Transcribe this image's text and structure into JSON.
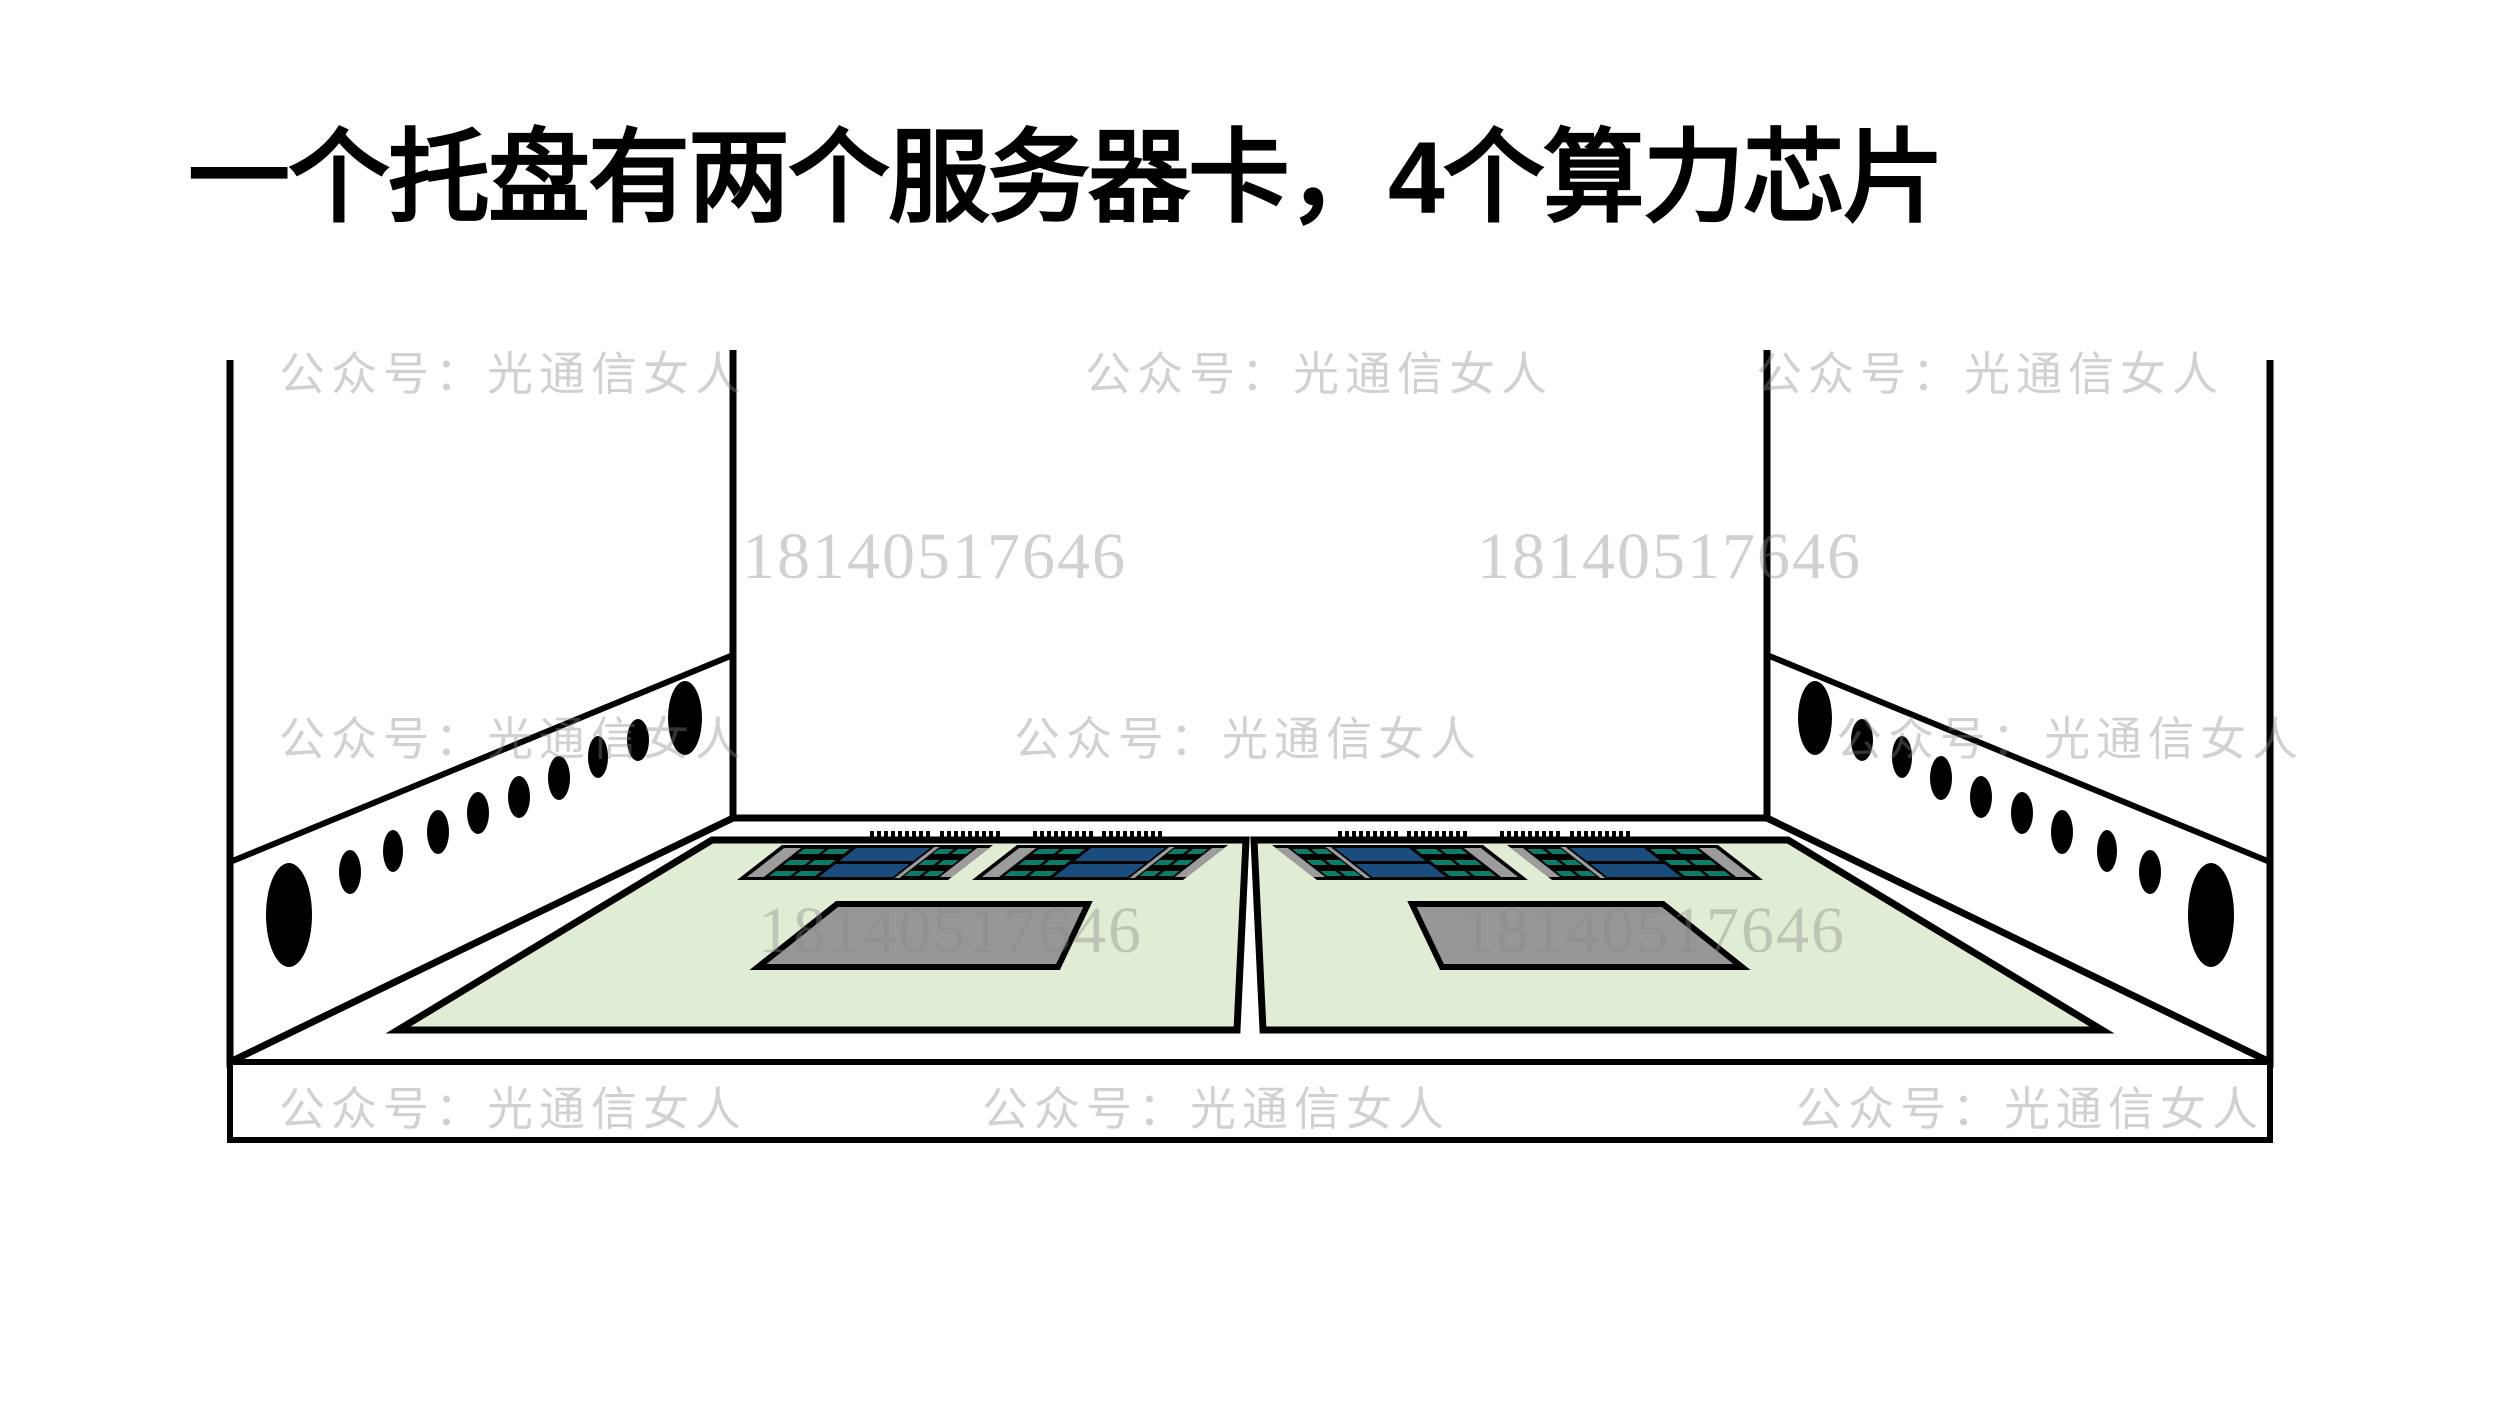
{
  "title": "一个托盘有两个服务器卡，4个算力芯片",
  "watermarks": {
    "account": "公众号：光通信女人",
    "phone": "18140517646"
  },
  "diagram": {
    "subject": "server-tray-illustration",
    "tray_count": 2,
    "server_cards_per_tray": 2,
    "compute_chips_per_card": 2,
    "vent_holes_per_wall": 10,
    "colors": {
      "tray_board_green": "#e0ecd4",
      "compute_chip_blue": "#1b4c7e",
      "memory_slot_teal": "#0c7c68",
      "guide_rail_gray": "#9c9c9c",
      "heatsink_gray": "#979797",
      "outline_black": "#000000",
      "watermark_gray": "#888888",
      "background_white": "#ffffff"
    }
  }
}
